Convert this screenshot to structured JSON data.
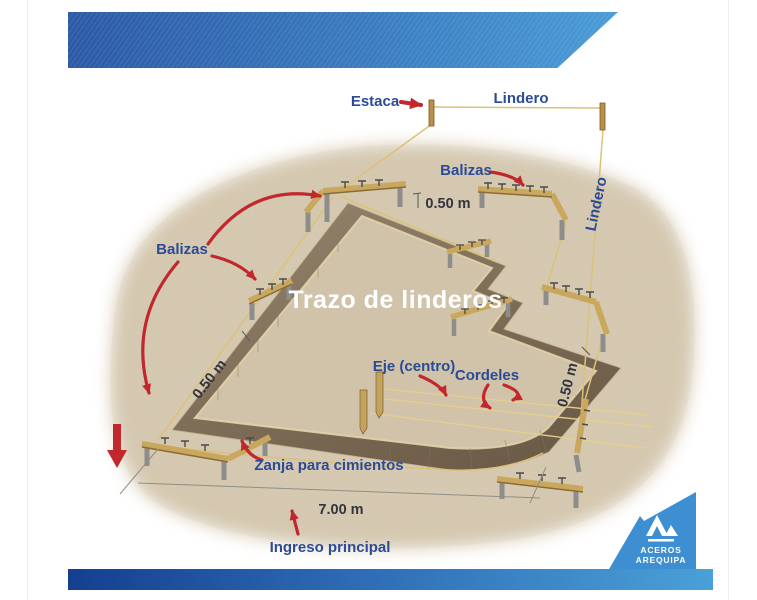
{
  "title": "Trazo de linderos",
  "diagram": {
    "labels": {
      "estaca": "Estaca",
      "lindero_top": "Lindero",
      "lindero_right": "Lindero",
      "balizas_right": "Balizas",
      "balizas_left": "Balizas",
      "eje_centro": "Eje (centro)",
      "cordeles": "Cordeles",
      "zanja": "Zanja para cimientos",
      "ingreso": "Ingreso principal"
    },
    "measurements": {
      "width_top": "0.50 m",
      "width_left": "0.50 m",
      "width_right": "0.50 m",
      "front_length": "7.00 m"
    }
  },
  "logo": {
    "line1": "ACEROS",
    "line2": "AREQUIPA"
  },
  "colors": {
    "banner_left": "#2c59a6",
    "banner_right": "#4a9cd6",
    "label_blue": "#2b4b97",
    "measure_dark": "#33343d",
    "arrow_red": "#c1272d",
    "ground": "#d9ccb4",
    "trench": "#7b6b55",
    "wood": "#c9a75c",
    "string_yellow": "#dcc178",
    "logo_blue": "#3d8fd2"
  }
}
